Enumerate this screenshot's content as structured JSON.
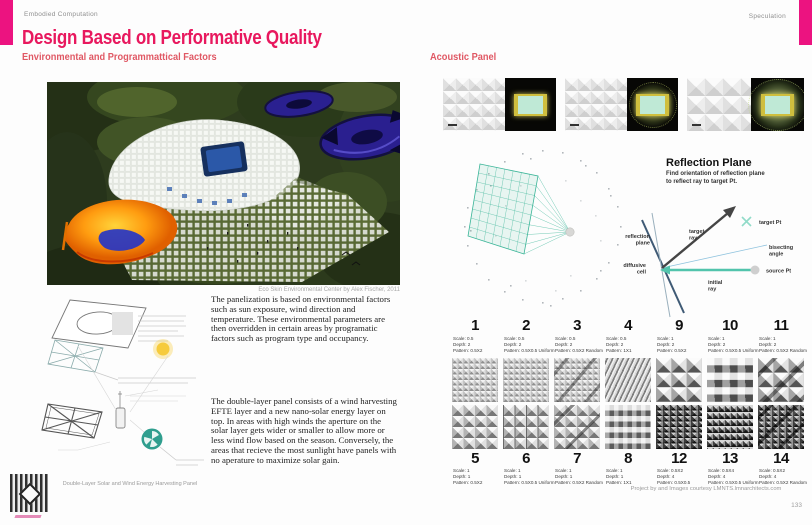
{
  "header": {
    "left_label": "Embodied Computation",
    "right_label": "Speculation",
    "title": "Design Based on Performative Quality",
    "left_subtitle": "Environmental and Programmattical Factors",
    "right_subtitle": "Acoustic Panel",
    "accent_pink": "#ec1380",
    "title_pink": "#e8185e"
  },
  "left_page": {
    "photo_caption": "Eco Skin Environmental Center by Alex Fischer, 2011",
    "paragraph_1": "The panelization is based on environmental factors such as sun exposure, wind direction and temperature.  These environmental parameters are then overridden in certain areas by programatic factors such as program type and occupancy.",
    "paragraph_2": "The double-layer panel consists of a wind harvesting EFTE layer and a new nano-solar energy layer on top.  In areas with high winds the aperture on the solar layer gets wider or smaller to allow more or less wind flow based on the season. Conversely, the areas that recieve the most sunlight have panels with no aperature to maximize solar gain.",
    "diagram_caption": "Double-Layer Solar and Wind Energy Harvesting Panel"
  },
  "right_page": {
    "reflection": {
      "title": "Reflection Plane",
      "subtitle_line1": "Find orientation of reflection plane",
      "subtitle_line2": "to reflect ray to target Pt.",
      "labels": {
        "target_pt": "target Pt",
        "source_pt": "source Pt",
        "target_l1": "target",
        "target_l2": "ray",
        "initial_l1": "initial",
        "initial_l2": "ray",
        "bisect_l1": "bisecting",
        "bisect_l2": "angle",
        "plane_l1": "reflection",
        "plane_l2": "plane",
        "cell_l1": "diffusive",
        "cell_l2": "cell"
      }
    },
    "patterns_row1": [
      {
        "num": "1",
        "scale": "Scale: 0.5",
        "depth": "Depth: 2",
        "pattern": "Pattern: 0.5X2"
      },
      {
        "num": "2",
        "scale": "Scale: 0.5",
        "depth": "Depth: 2",
        "pattern": "Pattern: 0.5X0.5 Uniform"
      },
      {
        "num": "3",
        "scale": "Scale: 0.5",
        "depth": "Depth: 2",
        "pattern": "Pattern: 0.5X2 Random"
      },
      {
        "num": "4",
        "scale": "Scale: 0.5",
        "depth": "Depth: 2",
        "pattern": "Pattern: 1X1"
      },
      {
        "num": "9",
        "scale": "Scale: 1",
        "depth": "Depth: 2",
        "pattern": "Pattern: 0.5X2"
      },
      {
        "num": "10",
        "scale": "Scale: 1",
        "depth": "Depth: 2",
        "pattern": "Pattern: 0.5X0.5 Uniform"
      },
      {
        "num": "11",
        "scale": "Scale: 1",
        "depth": "Depth: 2",
        "pattern": "Pattern: 0.5X2 Random"
      }
    ],
    "patterns_row2": [
      {
        "num": "5",
        "scale": "Scale: 1",
        "depth": "Depth: 1",
        "pattern": "Pattern: 0.5X2"
      },
      {
        "num": "6",
        "scale": "Scale: 1",
        "depth": "Depth: 1",
        "pattern": "Pattern: 0.5X0.5 Uniform"
      },
      {
        "num": "7",
        "scale": "Scale: 1",
        "depth": "Depth: 1",
        "pattern": "Pattern: 0.5X2 Random"
      },
      {
        "num": "8",
        "scale": "Scale: 1",
        "depth": "Depth: 1",
        "pattern": "Pattern: 1X1"
      },
      {
        "num": "12",
        "scale": "Scale: 0.5X2",
        "depth": "Depth: 4",
        "pattern": "Pattern: 0.5X0.5"
      },
      {
        "num": "13",
        "scale": "Scale: 0.5X4",
        "depth": "Depth: 4",
        "pattern": "Pattern: 0.5X0.5 Uniform"
      },
      {
        "num": "14",
        "scale": "Scale: 0.5X2",
        "depth": "Depth: 4",
        "pattern": "Pattern: 0.5X2 Random"
      }
    ],
    "credit": "Project by and Images courtesy LMNTS.lmnarchitects.com",
    "page_number": "133"
  }
}
